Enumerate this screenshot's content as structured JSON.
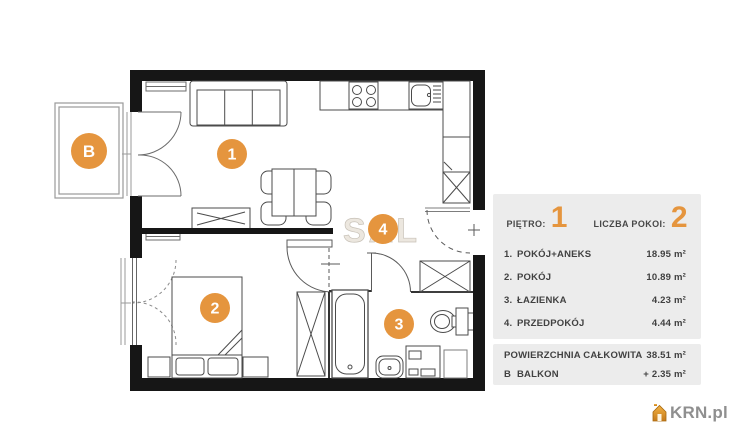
{
  "plan": {
    "watermark": "SAL",
    "circles": {
      "room1": "1",
      "room2": "2",
      "room3": "3",
      "room4": "4",
      "balcony": "B"
    }
  },
  "panel": {
    "floor_label": "PIĘTRO:",
    "floor_value": "1",
    "rooms_label": "LICZBA POKOI:",
    "rooms_value": "2",
    "rows": [
      {
        "num": "1.",
        "name": "POKÓJ+ANEKS",
        "area": "18.95 m²"
      },
      {
        "num": "2.",
        "name": "POKÓJ",
        "area": "10.89 m²"
      },
      {
        "num": "3.",
        "name": "ŁAZIENKA",
        "area": "4.23 m²"
      },
      {
        "num": "4.",
        "name": "PRZEDPOKÓJ",
        "area": "4.44 m²"
      }
    ],
    "summary_rows": [
      {
        "num": "",
        "name": "POWIERZCHNIA CAŁKOWITA",
        "area": "38.51 m²"
      },
      {
        "num": "B",
        "name": "BALKON",
        "area": "+ 2.35 m²"
      }
    ]
  },
  "logo": {
    "text": "KRN.pl"
  },
  "colors": {
    "accent": "#E5953E",
    "panel_bg": "#ECECEC",
    "wall": "#161616"
  }
}
